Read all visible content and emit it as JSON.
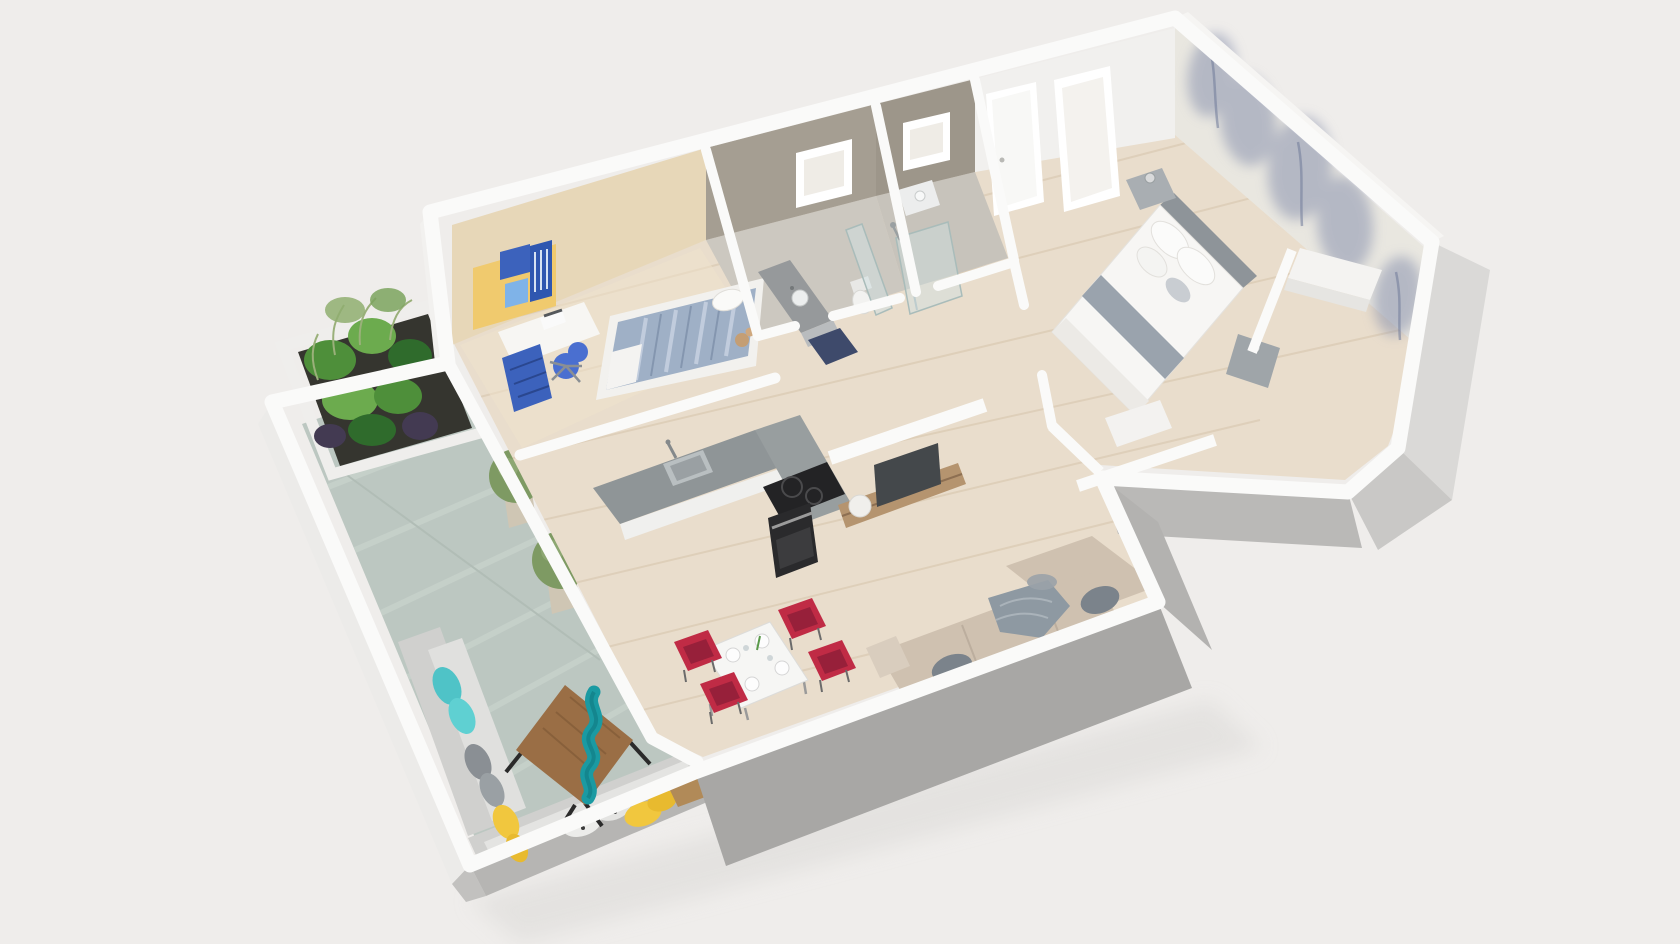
{
  "palette": {
    "background": "#efedeb",
    "ground_shadow": "#dcdad8",
    "wall_white": "#fafaf9",
    "wall_face_lit": "#f1f0ee",
    "wall_face_gray": "#c9c8c6",
    "wall_face_dark": "#a8a7a5",
    "notch_face": "#b3b2b0",
    "parapet_face": "#b6b5b3",
    "wood_floor": "#e9ddcc",
    "wood_plank": "#d6c4ab",
    "kids_floor": "#f0e4cc",
    "terrace_tile": "#bcc7c1",
    "terrace_tile_light": "#ccd5cf",
    "bath_floor": "#ccc8c0",
    "bath_tile": "#a59e92",
    "beige_wall": "#e7d7b8",
    "wallpaper_base": "#e9e7e0",
    "wallpaper_tree": "#8a93ae",
    "window_frame": "#ffffff",
    "door_white": "#f8f8f6",
    "shelf_yellow": "#f0ca6e",
    "furniture_blue": "#3c62bc",
    "chair_blue": "#4a6fd0",
    "kids_duvet": "#9fb0c6",
    "counter_top": "#8f9597",
    "cabinet_white": "#f0f0ee",
    "appliance_black": "#232325",
    "steel": "#b9bfc1",
    "tv_screen": "#44484b",
    "console_wood": "#b5946f",
    "vase_white": "#f0efec",
    "sofa_beige": "#cfc1b0",
    "sofa_beige_dark": "#bfb2a2",
    "cushion_gray": "#7b838b",
    "throw_gray": "#8e99a2",
    "table_white": "#f6f6f4",
    "chair_red": "#c02b45",
    "chair_red_dark": "#97203a",
    "bed_white": "#f7f6f4",
    "bed_band": "#9aa3ad",
    "headboard_gray": "#8e9499",
    "nightstand_gray": "#a9aeb2",
    "glass": "#cfe0e2",
    "navy_mat": "#3e4a6b",
    "toilet_white": "#f2f2f0",
    "outdoor_sofa": "#e0e0de",
    "outdoor_sofa_back": "#d0d0ce",
    "pillow_teal": "#4fc3c7",
    "pillow_yellow": "#f1c73e",
    "pillow_gray": "#8a8f94",
    "pillow_white": "#ececea",
    "river_wood": "#9a6e45",
    "river_teal": "#1a9aa2",
    "stool_wood": "#b18a58",
    "planter_box": "#35352f",
    "plant_dark": "#2f6b2c",
    "plant_mid": "#4e8f3a",
    "plant_light": "#6cab4e",
    "plant_accent": "#433a52",
    "topiary_green": "#7e9a63",
    "pot_tan": "#cfc6b4"
  },
  "scene": {
    "type": "3d-floor-plan-render",
    "rooms": [
      {
        "name": "terrace",
        "furniture": [
          "planter-box-with-plants",
          "topiary-tree",
          "topiary-tree",
          "outdoor-corner-sofa",
          "epoxy-river-coffee-table",
          "wood-stool"
        ]
      },
      {
        "name": "kids-room",
        "furniture": [
          "yellow-bookshelf",
          "desk-with-laptop",
          "blue-drawer-unit",
          "blue-office-chair",
          "single-bed",
          "teddy-bear"
        ]
      },
      {
        "name": "bathroom-1",
        "furniture": [
          "vanity-sink",
          "toilet",
          "glass-partition",
          "bath-mat"
        ]
      },
      {
        "name": "bathroom-2",
        "furniture": [
          "walk-in-shower",
          "glass-partition",
          "small-vanity"
        ]
      },
      {
        "name": "entry-hall",
        "furniture": [
          "entrance-door"
        ]
      },
      {
        "name": "master-bedroom",
        "furniture": [
          "double-bed",
          "nightstand",
          "nightstand",
          "built-in-desk",
          "tree-mural-wallpaper",
          "tall-window"
        ]
      },
      {
        "name": "kitchen",
        "furniture": [
          "l-shaped-counter",
          "sink",
          "induction-cooktop",
          "oven"
        ]
      },
      {
        "name": "living-room",
        "furniture": [
          "tv",
          "tv-console",
          "vase",
          "corner-sofa",
          "gray-throw",
          "laundry-cloth"
        ]
      },
      {
        "name": "dining-area",
        "furniture": [
          "dining-table",
          "dining-chair",
          "dining-chair",
          "dining-chair",
          "dining-chair"
        ]
      },
      {
        "name": "closet-hall",
        "furniture": [
          "wardrobe-niche"
        ]
      }
    ]
  }
}
